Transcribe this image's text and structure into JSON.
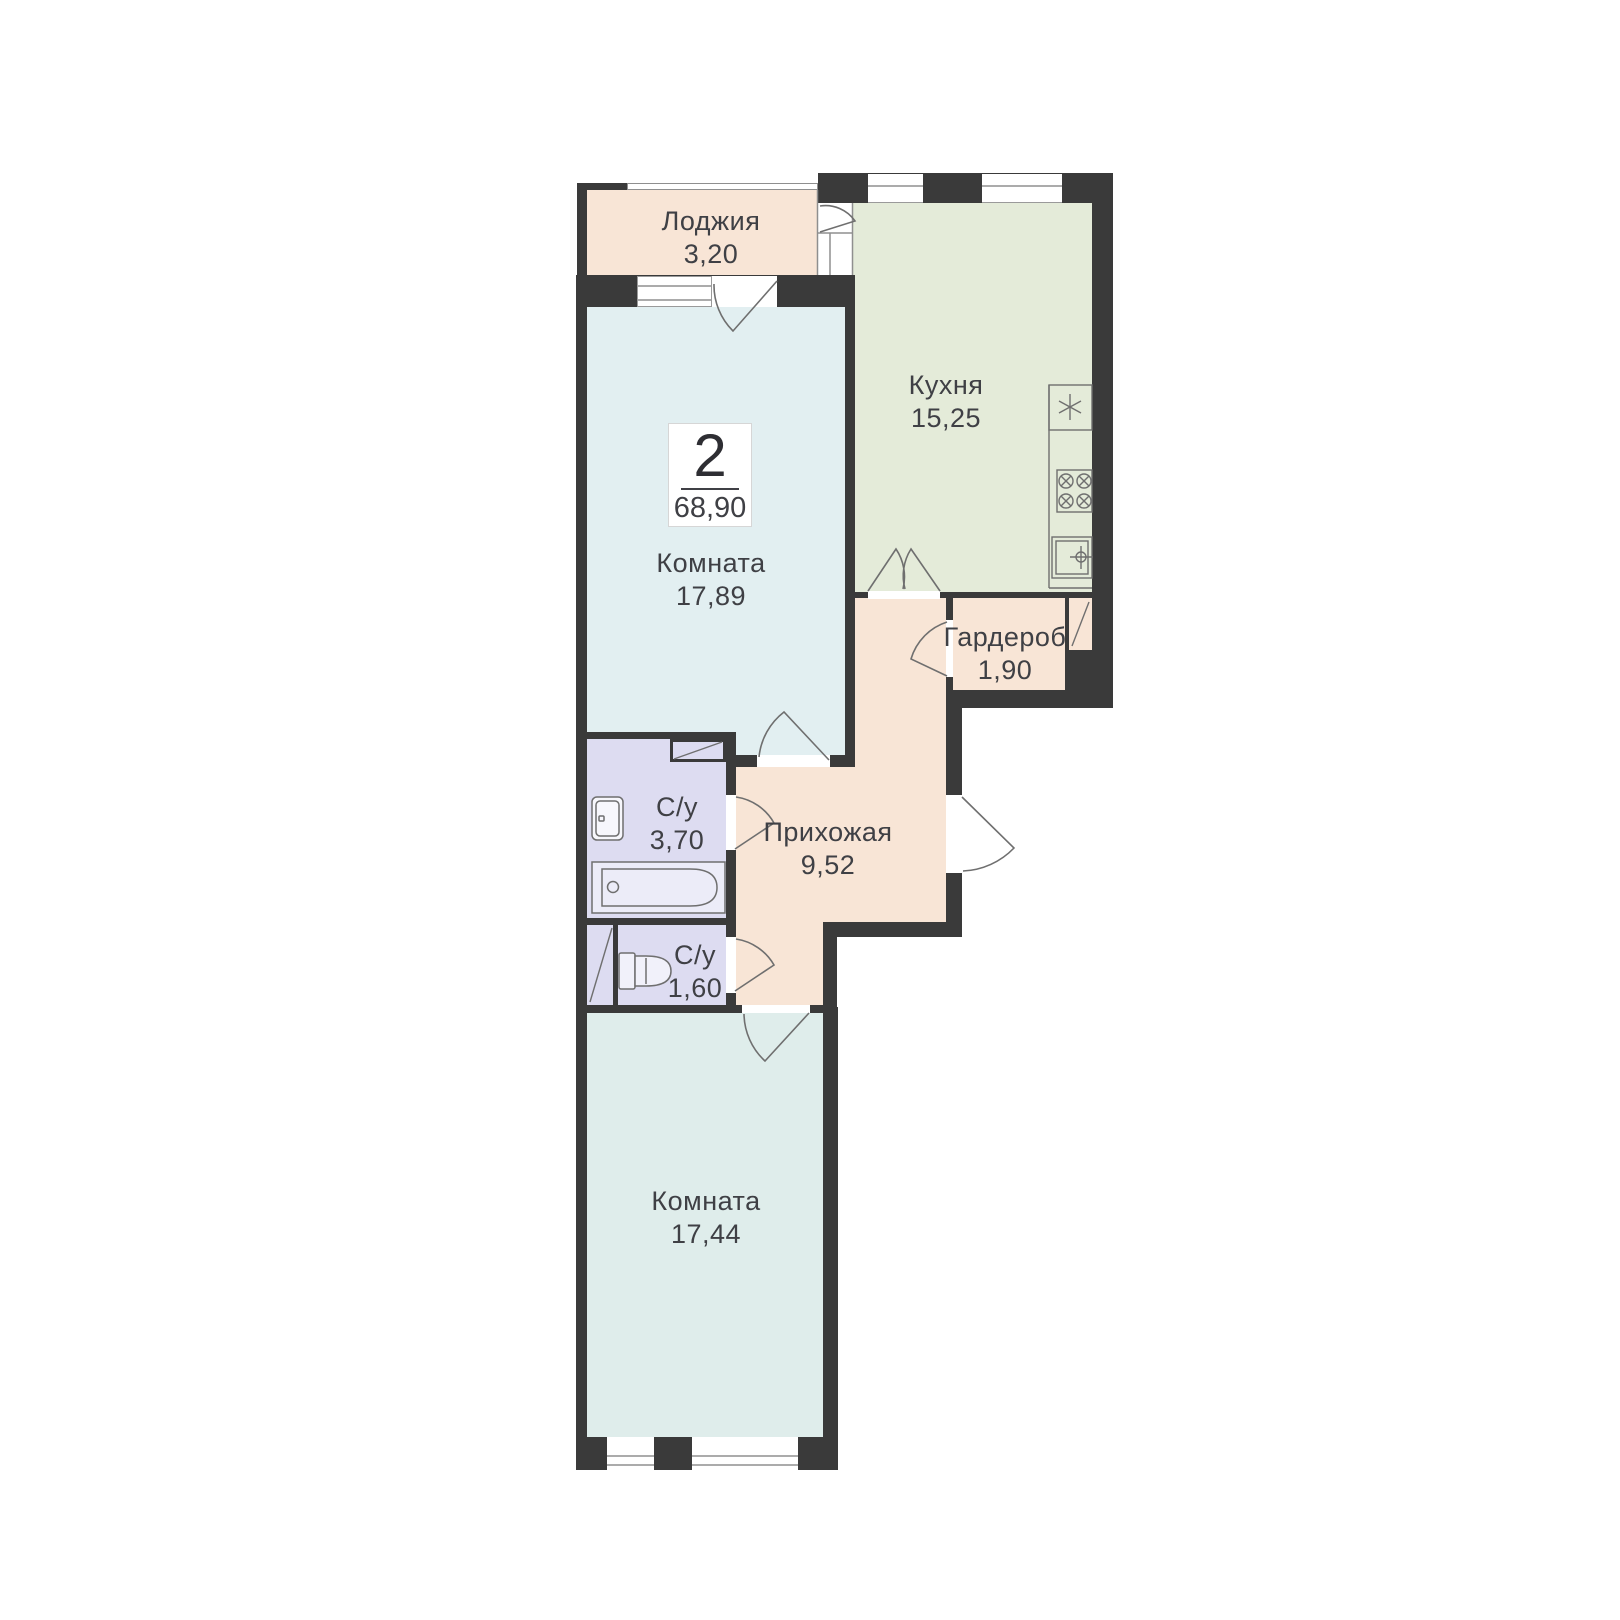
{
  "plan": {
    "title": "2-room apartment floor plan",
    "badge": {
      "rooms_count": "2",
      "total_area": "68,90"
    },
    "rooms": [
      {
        "id": "loggia",
        "name": "Лоджия",
        "area": "3,20"
      },
      {
        "id": "kitchen",
        "name": "Кухня",
        "area": "15,25"
      },
      {
        "id": "room1",
        "name": "Комната",
        "area": "17,89"
      },
      {
        "id": "wardrobe",
        "name": "Гардероб",
        "area": "1,90"
      },
      {
        "id": "bath1",
        "name": "С/у",
        "area": "3,70"
      },
      {
        "id": "hallway",
        "name": "Прихожая",
        "area": "9,52"
      },
      {
        "id": "bath2",
        "name": "С/у",
        "area": "1,60"
      },
      {
        "id": "room2",
        "name": "Комната",
        "area": "17,44"
      }
    ],
    "colors": {
      "wall": "#3a3a3a",
      "loggia_hall_wardrobe": "#f8e5d6",
      "kitchen": "#e4ebd9",
      "room1": "#e2eff1",
      "room2": "#dfedeb",
      "bathroom": "#dddcf1",
      "text": "#3f4045",
      "fixture_stroke": "#6f6f6f"
    },
    "icons": {
      "bathtub": "bathtub-icon",
      "wash_sink": "sink-icon",
      "toilet": "toilet-icon",
      "stove": "stove-icon",
      "fridge_star": "fridge-icon",
      "kitchen_sink": "kitchen-sink-icon",
      "vent_shaft": "vent-shaft-icon",
      "door_swing": "door-arc-icon",
      "window": "window-icon"
    }
  }
}
